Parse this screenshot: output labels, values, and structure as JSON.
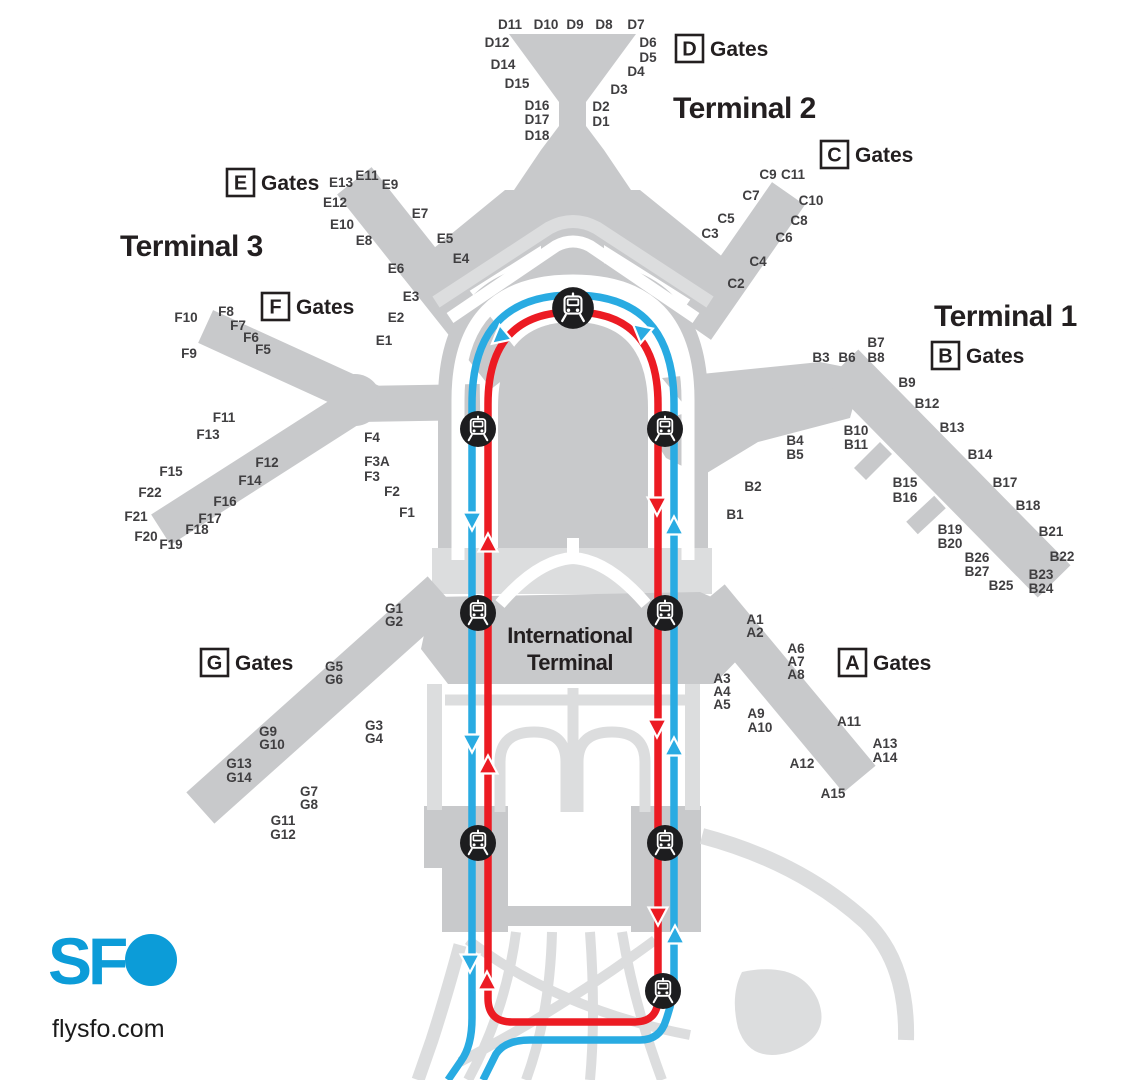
{
  "brand": {
    "logo_text_sf": "SF",
    "logo_site": "flysfo.com"
  },
  "colors": {
    "terminal": "#c8c9cb",
    "road": "#dcddde",
    "blue": "#29abe2",
    "red": "#ec1b23",
    "station": "#1d1d1f",
    "text": "#231f20",
    "gate": "#3f3e40",
    "brand": "#0c9cd8"
  },
  "headings": [
    {
      "text": "Terminal 2",
      "x": 673,
      "y": 118,
      "anchor": "start",
      "style": ""
    },
    {
      "text": "Terminal 3",
      "x": 120,
      "y": 256,
      "anchor": "start",
      "style": ""
    },
    {
      "text": "Terminal 1",
      "x": 934,
      "y": 326,
      "anchor": "start",
      "style": ""
    },
    {
      "text": "International Terminal",
      "lines": [
        "International",
        "Terminal"
      ],
      "x": 570,
      "y": 643,
      "anchor": "middle",
      "style": "md",
      "line_height": 27
    }
  ],
  "gate_groups": [
    {
      "letter": "D",
      "label": "Gates",
      "x": 676,
      "y": 35
    },
    {
      "letter": "C",
      "label": "Gates",
      "x": 821,
      "y": 141
    },
    {
      "letter": "E",
      "label": "Gates",
      "x": 227,
      "y": 169
    },
    {
      "letter": "F",
      "label": "Gates",
      "x": 262,
      "y": 293
    },
    {
      "letter": "B",
      "label": "Gates",
      "x": 932,
      "y": 342
    },
    {
      "letter": "A",
      "label": "Gates",
      "x": 839,
      "y": 649
    },
    {
      "letter": "G",
      "label": "Gates",
      "x": 201,
      "y": 649
    }
  ],
  "gates": [
    {
      "t": "D11",
      "x": 510,
      "y": 24
    },
    {
      "t": "D10",
      "x": 546,
      "y": 24
    },
    {
      "t": "D9",
      "x": 575,
      "y": 24
    },
    {
      "t": "D8",
      "x": 604,
      "y": 24
    },
    {
      "t": "D7",
      "x": 636,
      "y": 24
    },
    {
      "t": "D12",
      "x": 497,
      "y": 42
    },
    {
      "t": "D6",
      "x": 648,
      "y": 42
    },
    {
      "t": "D5",
      "x": 648,
      "y": 57
    },
    {
      "t": "D14",
      "x": 503,
      "y": 64
    },
    {
      "t": "D4",
      "x": 636,
      "y": 71
    },
    {
      "t": "D15",
      "x": 517,
      "y": 83
    },
    {
      "t": "D3",
      "x": 619,
      "y": 89
    },
    {
      "t": "D16",
      "x": 537,
      "y": 105
    },
    {
      "t": "D17",
      "x": 537,
      "y": 119
    },
    {
      "t": "D18",
      "x": 537,
      "y": 135
    },
    {
      "t": "D2",
      "x": 601,
      "y": 106
    },
    {
      "t": "D1",
      "x": 601,
      "y": 121
    },
    {
      "t": "C9",
      "x": 768,
      "y": 174
    },
    {
      "t": "C11",
      "x": 793,
      "y": 174
    },
    {
      "t": "C7",
      "x": 751,
      "y": 195
    },
    {
      "t": "C10",
      "x": 811,
      "y": 200
    },
    {
      "t": "C5",
      "x": 726,
      "y": 218
    },
    {
      "t": "C8",
      "x": 799,
      "y": 220
    },
    {
      "t": "C3",
      "x": 710,
      "y": 233
    },
    {
      "t": "C6",
      "x": 784,
      "y": 237
    },
    {
      "t": "C4",
      "x": 758,
      "y": 261
    },
    {
      "t": "C2",
      "x": 736,
      "y": 283
    },
    {
      "t": "E13",
      "x": 341,
      "y": 182
    },
    {
      "t": "E11",
      "x": 367,
      "y": 175
    },
    {
      "t": "E9",
      "x": 390,
      "y": 184
    },
    {
      "t": "E12",
      "x": 335,
      "y": 202
    },
    {
      "t": "E7",
      "x": 420,
      "y": 213
    },
    {
      "t": "E10",
      "x": 342,
      "y": 224
    },
    {
      "t": "E8",
      "x": 364,
      "y": 240
    },
    {
      "t": "E5",
      "x": 445,
      "y": 238
    },
    {
      "t": "E4",
      "x": 461,
      "y": 258
    },
    {
      "t": "E6",
      "x": 396,
      "y": 268
    },
    {
      "t": "E3",
      "x": 411,
      "y": 296
    },
    {
      "t": "E2",
      "x": 396,
      "y": 317
    },
    {
      "t": "E1",
      "x": 384,
      "y": 340
    },
    {
      "t": "F10",
      "x": 186,
      "y": 317
    },
    {
      "t": "F8",
      "x": 226,
      "y": 311
    },
    {
      "t": "F7",
      "x": 238,
      "y": 325
    },
    {
      "t": "F6",
      "x": 251,
      "y": 337
    },
    {
      "t": "F5",
      "x": 263,
      "y": 349
    },
    {
      "t": "F9",
      "x": 189,
      "y": 353
    },
    {
      "t": "F11",
      "x": 224,
      "y": 417
    },
    {
      "t": "F13",
      "x": 208,
      "y": 434
    },
    {
      "t": "F12",
      "x": 267,
      "y": 462
    },
    {
      "t": "F14",
      "x": 250,
      "y": 480
    },
    {
      "t": "F15",
      "x": 171,
      "y": 471
    },
    {
      "t": "F22",
      "x": 150,
      "y": 492
    },
    {
      "t": "F21",
      "x": 136,
      "y": 516
    },
    {
      "t": "F20",
      "x": 146,
      "y": 536
    },
    {
      "t": "F19",
      "x": 171,
      "y": 544
    },
    {
      "t": "F16",
      "x": 225,
      "y": 501
    },
    {
      "t": "F17",
      "x": 210,
      "y": 518
    },
    {
      "t": "F18",
      "x": 197,
      "y": 529
    },
    {
      "t": "F4",
      "x": 372,
      "y": 437
    },
    {
      "t": "F3A",
      "x": 377,
      "y": 461
    },
    {
      "t": "F3",
      "x": 372,
      "y": 476
    },
    {
      "t": "F2",
      "x": 392,
      "y": 491
    },
    {
      "t": "F1",
      "x": 407,
      "y": 512
    },
    {
      "t": "B3",
      "x": 821,
      "y": 357
    },
    {
      "t": "B6",
      "x": 847,
      "y": 357
    },
    {
      "t": "B7",
      "x": 876,
      "y": 342
    },
    {
      "t": "B8",
      "x": 876,
      "y": 357
    },
    {
      "t": "B9",
      "x": 907,
      "y": 382
    },
    {
      "t": "B12",
      "x": 927,
      "y": 403
    },
    {
      "t": "B13",
      "x": 952,
      "y": 427
    },
    {
      "t": "B14",
      "x": 980,
      "y": 454
    },
    {
      "t": "B10",
      "x": 856,
      "y": 430
    },
    {
      "t": "B11",
      "x": 856,
      "y": 444
    },
    {
      "t": "B4",
      "x": 795,
      "y": 440
    },
    {
      "t": "B5",
      "x": 795,
      "y": 454
    },
    {
      "t": "B2",
      "x": 753,
      "y": 486
    },
    {
      "t": "B1",
      "x": 735,
      "y": 514
    },
    {
      "t": "B15",
      "x": 905,
      "y": 482
    },
    {
      "t": "B16",
      "x": 905,
      "y": 497
    },
    {
      "t": "B17",
      "x": 1005,
      "y": 482
    },
    {
      "t": "B18",
      "x": 1028,
      "y": 505
    },
    {
      "t": "B19",
      "x": 950,
      "y": 529
    },
    {
      "t": "B20",
      "x": 950,
      "y": 543
    },
    {
      "t": "B21",
      "x": 1051,
      "y": 531
    },
    {
      "t": "B22",
      "x": 1062,
      "y": 556
    },
    {
      "t": "B26",
      "x": 977,
      "y": 557
    },
    {
      "t": "B27",
      "x": 977,
      "y": 571
    },
    {
      "t": "B23",
      "x": 1041,
      "y": 574
    },
    {
      "t": "B24",
      "x": 1041,
      "y": 588
    },
    {
      "t": "B25",
      "x": 1001,
      "y": 585
    },
    {
      "t": "A1",
      "x": 755,
      "y": 619
    },
    {
      "t": "A2",
      "x": 755,
      "y": 632
    },
    {
      "t": "A6",
      "x": 796,
      "y": 648
    },
    {
      "t": "A7",
      "x": 796,
      "y": 661
    },
    {
      "t": "A8",
      "x": 796,
      "y": 674
    },
    {
      "t": "A3",
      "x": 722,
      "y": 678
    },
    {
      "t": "A4",
      "x": 722,
      "y": 691
    },
    {
      "t": "A5",
      "x": 722,
      "y": 704
    },
    {
      "t": "A9",
      "x": 756,
      "y": 713
    },
    {
      "t": "A10",
      "x": 760,
      "y": 727
    },
    {
      "t": "A11",
      "x": 849,
      "y": 721
    },
    {
      "t": "A13",
      "x": 885,
      "y": 743
    },
    {
      "t": "A14",
      "x": 885,
      "y": 757
    },
    {
      "t": "A12",
      "x": 802,
      "y": 763
    },
    {
      "t": "A15",
      "x": 833,
      "y": 793
    },
    {
      "t": "G1",
      "x": 394,
      "y": 608
    },
    {
      "t": "G2",
      "x": 394,
      "y": 621
    },
    {
      "t": "G5",
      "x": 334,
      "y": 666
    },
    {
      "t": "G6",
      "x": 334,
      "y": 679
    },
    {
      "t": "G3",
      "x": 374,
      "y": 725
    },
    {
      "t": "G4",
      "x": 374,
      "y": 738
    },
    {
      "t": "G9",
      "x": 268,
      "y": 731
    },
    {
      "t": "G10",
      "x": 272,
      "y": 744
    },
    {
      "t": "G13",
      "x": 239,
      "y": 763
    },
    {
      "t": "G14",
      "x": 239,
      "y": 777
    },
    {
      "t": "G7",
      "x": 309,
      "y": 791
    },
    {
      "t": "G8",
      "x": 309,
      "y": 804
    },
    {
      "t": "G11",
      "x": 283,
      "y": 820
    },
    {
      "t": "G12",
      "x": 283,
      "y": 834
    }
  ],
  "stations": [
    {
      "x": 573,
      "y": 308,
      "s": 1.16
    },
    {
      "x": 478,
      "y": 429,
      "s": 1
    },
    {
      "x": 665,
      "y": 429,
      "s": 1
    },
    {
      "x": 478,
      "y": 613,
      "s": 1
    },
    {
      "x": 665,
      "y": 613,
      "s": 1
    },
    {
      "x": 478,
      "y": 843,
      "s": 1
    },
    {
      "x": 665,
      "y": 843,
      "s": 1
    },
    {
      "x": 663,
      "y": 991,
      "s": 1
    }
  ],
  "arrows": [
    {
      "x": 500,
      "y": 337,
      "r": 230,
      "line": "blue"
    },
    {
      "x": 641,
      "y": 331,
      "r": 310,
      "line": "blue"
    },
    {
      "x": 472,
      "y": 520,
      "r": 180,
      "line": "blue"
    },
    {
      "x": 472,
      "y": 742,
      "r": 180,
      "line": "blue"
    },
    {
      "x": 470,
      "y": 962,
      "r": 180,
      "line": "blue"
    },
    {
      "x": 674,
      "y": 527,
      "r": 0,
      "line": "blue"
    },
    {
      "x": 674,
      "y": 748,
      "r": 0,
      "line": "blue"
    },
    {
      "x": 675,
      "y": 936,
      "r": 0,
      "line": "blue"
    },
    {
      "x": 488,
      "y": 544,
      "r": 0,
      "line": "red"
    },
    {
      "x": 488,
      "y": 766,
      "r": 0,
      "line": "red"
    },
    {
      "x": 487,
      "y": 982,
      "r": 0,
      "line": "red"
    },
    {
      "x": 657,
      "y": 505,
      "r": 180,
      "line": "red"
    },
    {
      "x": 657,
      "y": 727,
      "r": 180,
      "line": "red"
    },
    {
      "x": 658,
      "y": 915,
      "r": 180,
      "line": "red"
    }
  ]
}
